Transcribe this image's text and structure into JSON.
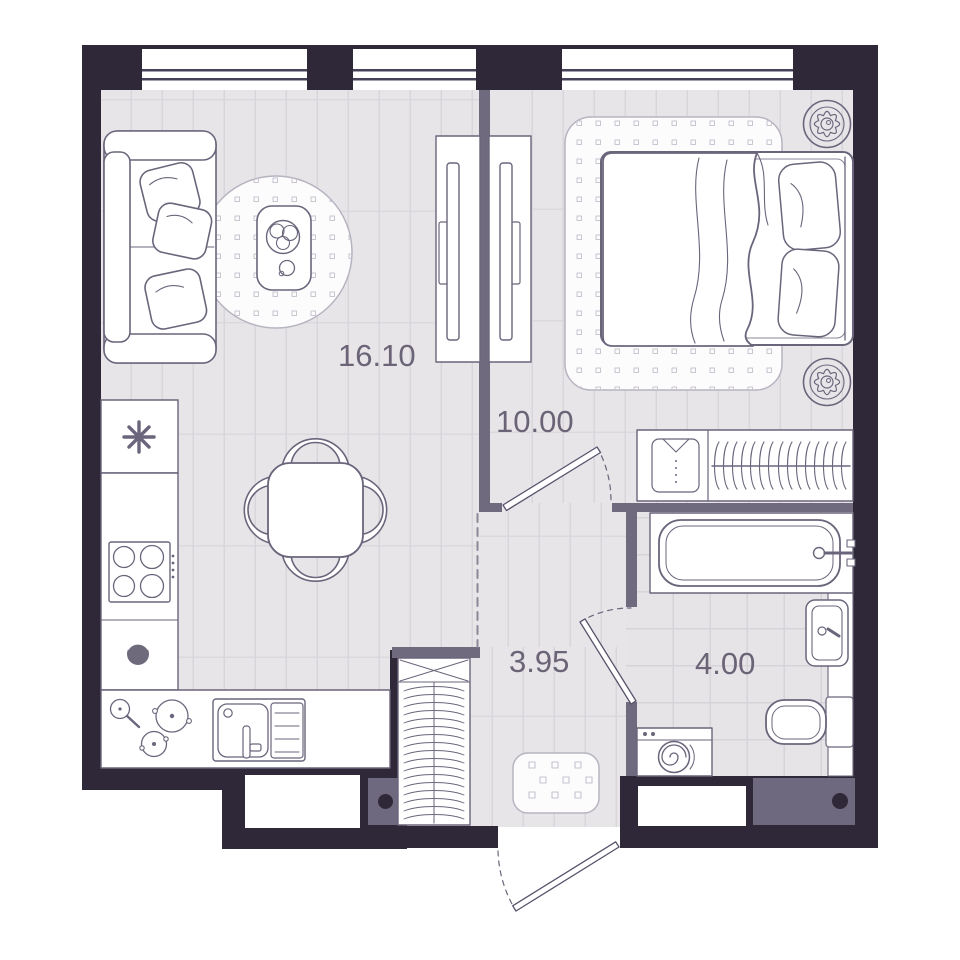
{
  "floorplan": {
    "rooms": [
      {
        "id": "living-room-kitchen",
        "area": "16.10",
        "furniture": [
          "sofa",
          "round-rug",
          "coffee-table",
          "plant",
          "tv-unit",
          "dining-table",
          "four-chairs",
          "fridge",
          "stove",
          "kitchen-counter",
          "kitchen-sink",
          "pots-and-pans"
        ]
      },
      {
        "id": "bedroom",
        "area": "10.00",
        "furniture": [
          "double-bed",
          "pillows",
          "blanket",
          "rug",
          "tv-dresser",
          "wardrobe",
          "plant-top",
          "plant-bottom"
        ]
      },
      {
        "id": "hallway",
        "area": "3.95",
        "furniture": [
          "shoe-cabinet",
          "doormat"
        ]
      },
      {
        "id": "bathroom",
        "area": "4.00",
        "furniture": [
          "bathtub",
          "washbasin",
          "toilet",
          "washing-machine",
          "counter"
        ]
      }
    ],
    "windows_count": 3,
    "doors_count": 3,
    "icons": {
      "fridge": "snowflake-icon",
      "bedroom_decor": "plant-icon",
      "wardrobe_left": "shirt-icon",
      "wardrobe_right": "hangers-icon",
      "washing_machine": "spiral-drum-icon"
    },
    "colors": {
      "outer_wall": "#2e2838",
      "partition_wall": "#706a7e",
      "floor": "#e7e5e8",
      "floor_line": "#d9d6db",
      "tile_line": "#d7d4d9",
      "furniture_outline": "#6b657b",
      "rug_border": "#b8b3c1",
      "label_text": "#6b6477",
      "window_glass_line": "#47415a",
      "background": "#ffffff"
    }
  }
}
